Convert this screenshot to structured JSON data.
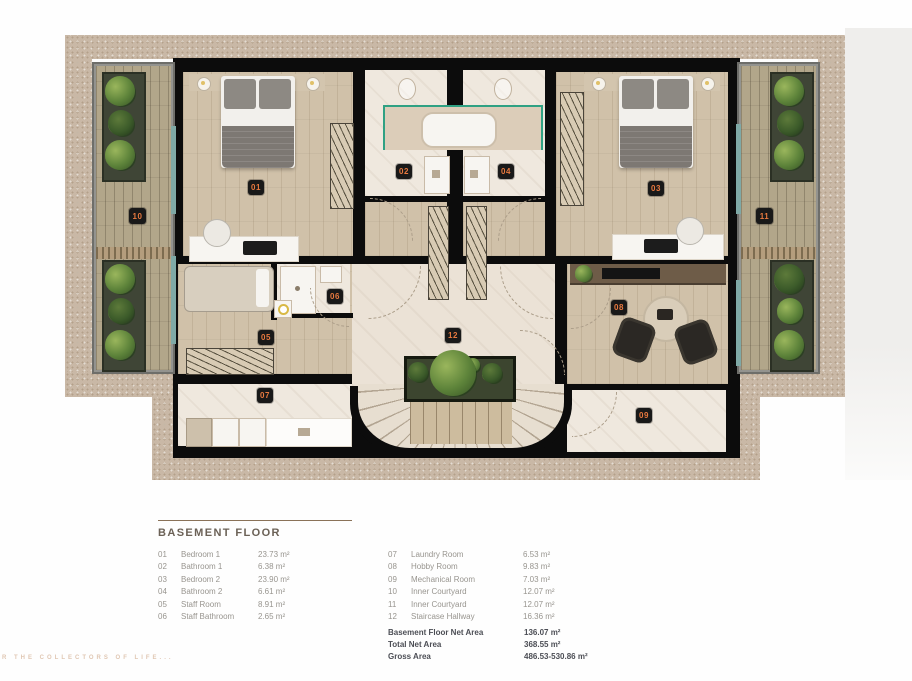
{
  "watermark": "R THE COLLECTORS OF LIFE...",
  "legend": {
    "title": "BASEMENT FLOOR",
    "items_left": [
      {
        "num": "01",
        "name": "Bedroom 1",
        "area": "23.73 m²"
      },
      {
        "num": "02",
        "name": "Bathroom 1",
        "area": "6.38 m²"
      },
      {
        "num": "03",
        "name": "Bedroom 2",
        "area": "23.90 m²"
      },
      {
        "num": "04",
        "name": "Bathroom 2",
        "area": "6.61 m²"
      },
      {
        "num": "05",
        "name": "Staff Room",
        "area": "8.91 m²"
      },
      {
        "num": "06",
        "name": "Staff Bathroom",
        "area": "2.65 m²"
      }
    ],
    "items_right": [
      {
        "num": "07",
        "name": "Laundry Room",
        "area": "6.53 m²"
      },
      {
        "num": "08",
        "name": "Hobby Room",
        "area": "9.83 m²"
      },
      {
        "num": "09",
        "name": "Mechanical Room",
        "area": "7.03 m²"
      },
      {
        "num": "10",
        "name": "Inner Courtyard",
        "area": "12.07 m²"
      },
      {
        "num": "11",
        "name": "Inner Courtyard",
        "area": "12.07 m²"
      },
      {
        "num": "12",
        "name": "Staircase Hallway",
        "area": "16.36 m²"
      }
    ],
    "totals": [
      {
        "label": "Basement Floor Net Area",
        "value": "136.07 m²"
      },
      {
        "label": "Total Net Area",
        "value": "368.55 m²"
      },
      {
        "label": "Gross Area",
        "value": "486.53-530.86 m²"
      }
    ]
  },
  "plan": {
    "badges": [
      "01",
      "02",
      "03",
      "04",
      "05",
      "06",
      "07",
      "08",
      "09",
      "10",
      "11",
      "12"
    ],
    "colors": {
      "wall": "#0c0c0c",
      "band": "#c9b8a6",
      "badge_bg": "#191919",
      "badge_text": "#e8793f",
      "wood_floor": "#d0c1a9",
      "tile_floor": "#efe8de",
      "deck": "#b2a68a",
      "glass_green": "#2fa183"
    }
  }
}
